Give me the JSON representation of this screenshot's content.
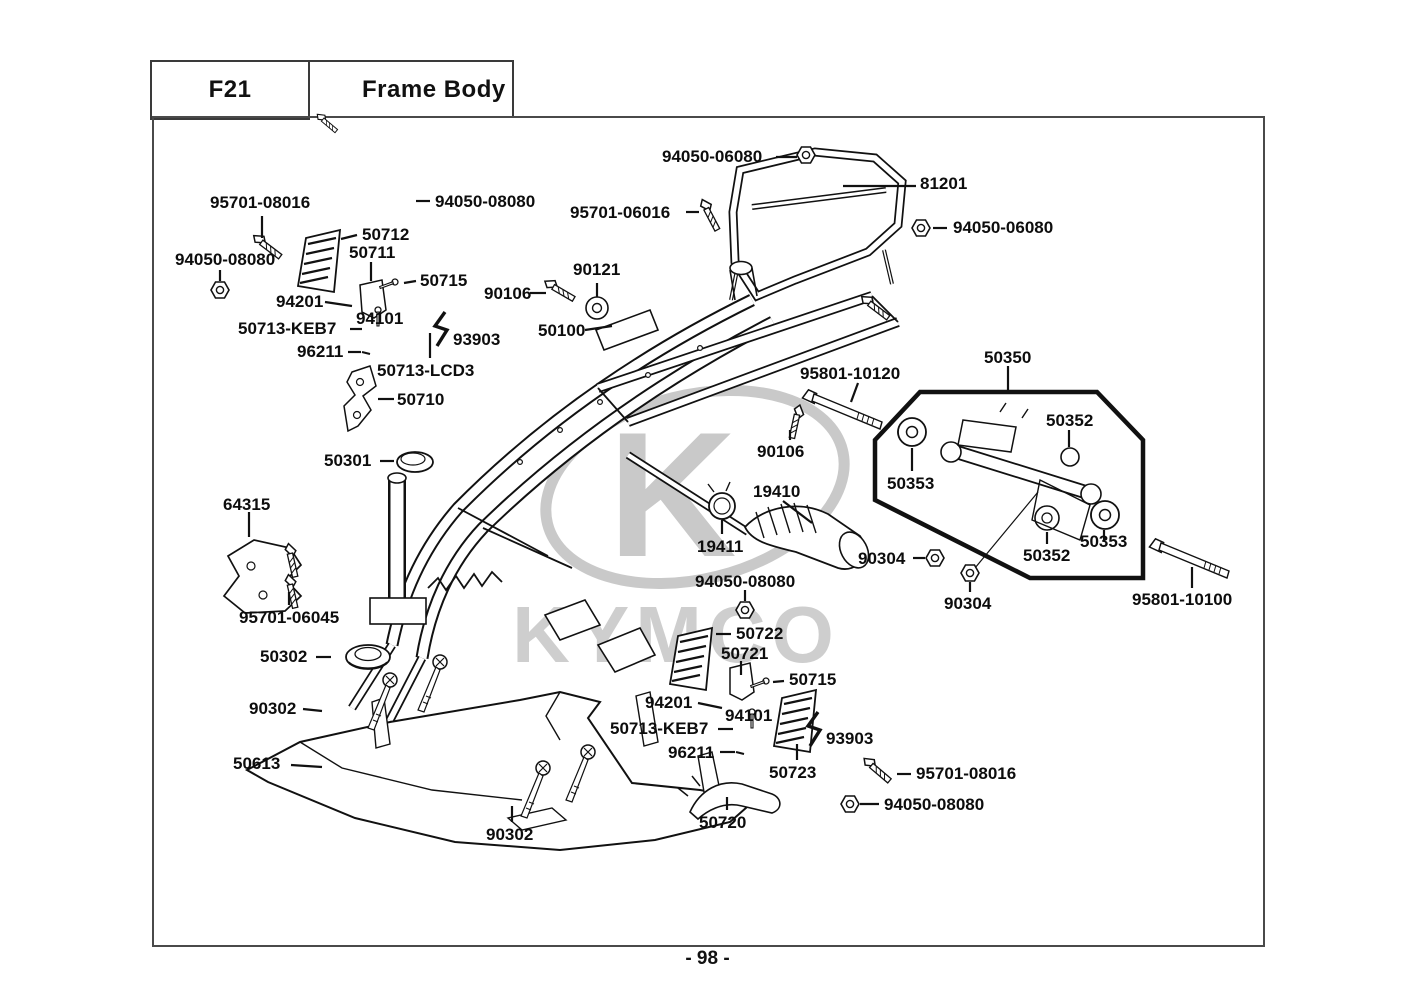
{
  "header": {
    "code": "F21",
    "title": "Frame Body"
  },
  "footer": {
    "page_number": "- 98 -"
  },
  "watermark": {
    "brand": "KYMCO",
    "logo_letter": "K"
  },
  "diagram": {
    "labels": [
      {
        "text": "94050-06080",
        "x": 662,
        "y": 148
      },
      {
        "text": "81201",
        "x": 920,
        "y": 175
      },
      {
        "text": "95701-06016",
        "x": 570,
        "y": 204
      },
      {
        "text": "94050-06080",
        "x": 953,
        "y": 219
      },
      {
        "text": "95701-08016",
        "x": 210,
        "y": 194
      },
      {
        "text": "94050-08080",
        "x": 435,
        "y": 193
      },
      {
        "text": "94050-08080",
        "x": 175,
        "y": 251
      },
      {
        "text": "50712",
        "x": 362,
        "y": 226
      },
      {
        "text": "50711",
        "x": 349,
        "y": 244
      },
      {
        "text": "50715",
        "x": 420,
        "y": 272
      },
      {
        "text": "94201",
        "x": 276,
        "y": 293
      },
      {
        "text": "94101",
        "x": 356,
        "y": 310
      },
      {
        "text": "50713-KEB7",
        "x": 238,
        "y": 320
      },
      {
        "text": "96211",
        "x": 297,
        "y": 343
      },
      {
        "text": "50713-LCD3",
        "x": 377,
        "y": 362
      },
      {
        "text": "50710",
        "x": 397,
        "y": 391
      },
      {
        "text": "93903",
        "x": 453,
        "y": 331
      },
      {
        "text": "90121",
        "x": 573,
        "y": 261
      },
      {
        "text": "90106",
        "x": 484,
        "y": 285
      },
      {
        "text": "50100",
        "x": 538,
        "y": 322
      },
      {
        "text": "95801-10120",
        "x": 800,
        "y": 365
      },
      {
        "text": "50350",
        "x": 984,
        "y": 349
      },
      {
        "text": "50352",
        "x": 1046,
        "y": 412
      },
      {
        "text": "50353",
        "x": 887,
        "y": 475
      },
      {
        "text": "50353",
        "x": 1080,
        "y": 533
      },
      {
        "text": "50352",
        "x": 1023,
        "y": 547
      },
      {
        "text": "90304",
        "x": 858,
        "y": 550
      },
      {
        "text": "90304",
        "x": 944,
        "y": 595
      },
      {
        "text": "95801-10100",
        "x": 1132,
        "y": 591
      },
      {
        "text": "90106",
        "x": 757,
        "y": 443
      },
      {
        "text": "19410",
        "x": 753,
        "y": 483
      },
      {
        "text": "19411",
        "x": 697,
        "y": 538
      },
      {
        "text": "94050-08080",
        "x": 695,
        "y": 573
      },
      {
        "text": "50722",
        "x": 736,
        "y": 625
      },
      {
        "text": "50721",
        "x": 721,
        "y": 645
      },
      {
        "text": "50715",
        "x": 789,
        "y": 671
      },
      {
        "text": "94201",
        "x": 645,
        "y": 694
      },
      {
        "text": "94101",
        "x": 725,
        "y": 707
      },
      {
        "text": "50713-KEB7",
        "x": 610,
        "y": 720
      },
      {
        "text": "96211",
        "x": 668,
        "y": 744
      },
      {
        "text": "93903",
        "x": 826,
        "y": 730
      },
      {
        "text": "50723",
        "x": 769,
        "y": 764
      },
      {
        "text": "95701-08016",
        "x": 916,
        "y": 765
      },
      {
        "text": "94050-08080",
        "x": 884,
        "y": 796
      },
      {
        "text": "64315",
        "x": 223,
        "y": 496
      },
      {
        "text": "95701-06045",
        "x": 239,
        "y": 609
      },
      {
        "text": "50301",
        "x": 324,
        "y": 452
      },
      {
        "text": "50302",
        "x": 260,
        "y": 648
      },
      {
        "text": "90302",
        "x": 249,
        "y": 700
      },
      {
        "text": "90302",
        "x": 486,
        "y": 826
      },
      {
        "text": "50613",
        "x": 233,
        "y": 755
      },
      {
        "text": "50720",
        "x": 699,
        "y": 814
      }
    ]
  }
}
